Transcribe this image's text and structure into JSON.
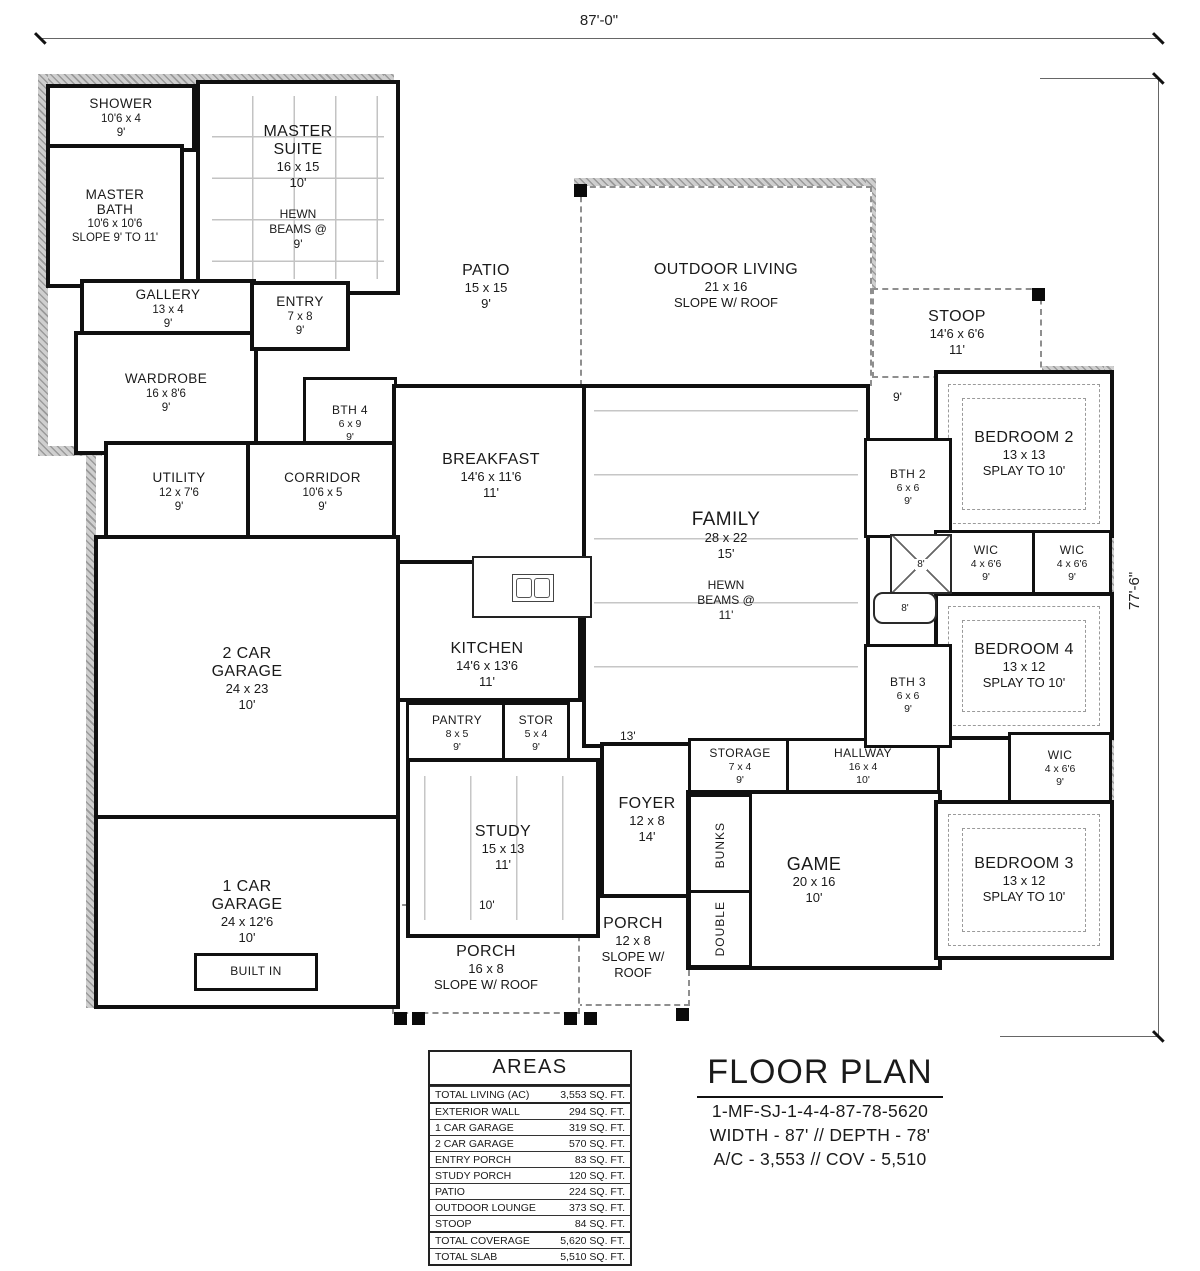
{
  "dimensions": {
    "width": "87'-0\"",
    "depth": "77'-6\""
  },
  "rooms": {
    "shower": {
      "name": "SHOWER",
      "size": "10'6 x 4",
      "ceiling": "9'"
    },
    "master_bath": {
      "name": "MASTER BATH",
      "size": "10'6 x 10'6",
      "ceiling": "SLOPE 9' TO 11'"
    },
    "master_suite": {
      "name": "MASTER SUITE",
      "size": "16 x 15",
      "ceiling": "10'"
    },
    "gallery": {
      "name": "GALLERY",
      "size": "13 x 4",
      "ceiling": "9'"
    },
    "wardrobe": {
      "name": "WARDROBE",
      "size": "16 x 8'6",
      "ceiling": "9'"
    },
    "entry": {
      "name": "ENTRY",
      "size": "7 x 8",
      "ceiling": "9'"
    },
    "bth4": {
      "name": "BTH 4",
      "size": "6 x 9",
      "ceiling": "9'"
    },
    "utility": {
      "name": "UTILITY",
      "size": "12 x 7'6",
      "ceiling": "9'"
    },
    "corridor": {
      "name": "CORRIDOR",
      "size": "10'6 x 5",
      "ceiling": "9'"
    },
    "patio": {
      "name": "PATIO",
      "size": "15 x 15",
      "ceiling": "9'"
    },
    "outdoor_living": {
      "name": "OUTDOOR LIVING",
      "size": "21 x 16",
      "ceiling": "SLOPE W/ ROOF"
    },
    "stoop": {
      "name": "STOOP",
      "size": "14'6 x 6'6",
      "ceiling": "11'"
    },
    "bedroom2": {
      "name": "BEDROOM 2",
      "size": "13 x 13",
      "ceiling": "SPLAY TO 10'"
    },
    "bth2": {
      "name": "BTH 2",
      "size": "6 x 6",
      "ceiling": "9'"
    },
    "wic1": {
      "name": "WIC",
      "size": "4 x 6'6",
      "ceiling": "9'"
    },
    "wic2": {
      "name": "WIC",
      "size": "4 x 6'6",
      "ceiling": "9'"
    },
    "wic3": {
      "name": "WIC",
      "size": "4 x 6'6",
      "ceiling": "9'"
    },
    "breakfast": {
      "name": "BREAKFAST",
      "size": "14'6 x 11'6",
      "ceiling": "11'"
    },
    "kitchen": {
      "name": "KITCHEN",
      "size": "14'6 x 13'6",
      "ceiling": "11'"
    },
    "family": {
      "name": "FAMILY",
      "size": "28 x 22",
      "ceiling": "15'"
    },
    "bedroom4": {
      "name": "BEDROOM 4",
      "size": "13 x 12",
      "ceiling": "SPLAY TO 10'"
    },
    "bth3": {
      "name": "BTH 3",
      "size": "6 x 6",
      "ceiling": "9'"
    },
    "garage2": {
      "name": "2 CAR GARAGE",
      "size": "24 x 23",
      "ceiling": "10'"
    },
    "pantry": {
      "name": "PANTRY",
      "size": "8 x 5",
      "ceiling": "9'"
    },
    "stor": {
      "name": "STOR",
      "size": "5 x 4",
      "ceiling": "9'"
    },
    "study": {
      "name": "STUDY",
      "size": "15 x 13",
      "ceiling": "11'"
    },
    "foyer": {
      "name": "FOYER",
      "size": "12 x 8",
      "ceiling": "14'"
    },
    "storage": {
      "name": "STORAGE",
      "size": "7 x 4",
      "ceiling": "9'"
    },
    "hallway": {
      "name": "HALLWAY",
      "size": "16 x 4",
      "ceiling": "10'"
    },
    "game": {
      "name": "GAME",
      "size": "20 x 16",
      "ceiling": "10'"
    },
    "bedroom3": {
      "name": "BEDROOM 3",
      "size": "13 x 12",
      "ceiling": "SPLAY TO 10'"
    },
    "garage1": {
      "name": "1 CAR GARAGE",
      "size": "24 x 12'6",
      "ceiling": "10'"
    },
    "porch": {
      "name": "PORCH",
      "size": "12 x 8",
      "ceiling": "SLOPE W/ ROOF"
    },
    "covered_porch": {
      "name": "COVERED PORCH",
      "size": "16 x 8",
      "ceiling": "SLOPE W/ ROOF"
    }
  },
  "annotations": {
    "hewn_beams_master": "HEWN BEAMS @ 9'",
    "hewn_beams_family": "HEWN BEAMS @ 11'"
  },
  "labels": {
    "nine": "9'",
    "eight_shower": "8'",
    "eight_tub": "8'",
    "thirteen": "13'",
    "ten": "10'",
    "built_in": "BUILT IN",
    "bunks": "BUNKS",
    "double": "DOUBLE"
  },
  "areas_table": {
    "title": "AREAS",
    "rows": [
      {
        "label": "TOTAL LIVING (AC)",
        "value": "3,553 SQ. FT."
      },
      {
        "label": "EXTERIOR WALL",
        "value": "294 SQ. FT."
      },
      {
        "label": "1 CAR GARAGE",
        "value": "319 SQ. FT."
      },
      {
        "label": "2 CAR GARAGE",
        "value": "570 SQ. FT."
      },
      {
        "label": "ENTRY PORCH",
        "value": "83 SQ. FT."
      },
      {
        "label": "STUDY PORCH",
        "value": "120 SQ. FT."
      },
      {
        "label": "PATIO",
        "value": "224 SQ. FT."
      },
      {
        "label": "OUTDOOR LOUNGE",
        "value": "373 SQ. FT."
      },
      {
        "label": "STOOP",
        "value": "84 SQ. FT."
      },
      {
        "label": "TOTAL COVERAGE",
        "value": "5,620 SQ. FT."
      },
      {
        "label": "TOTAL SLAB",
        "value": "5,510 SQ. FT."
      }
    ]
  },
  "title_block": {
    "title": "FLOOR PLAN",
    "plan_number": "1-MF-SJ-1-4-4-87-78-5620",
    "dimensions_line": "WIDTH - 87' // DEPTH - 78'",
    "area_line": "A/C - 3,553 // COV - 5,510"
  }
}
